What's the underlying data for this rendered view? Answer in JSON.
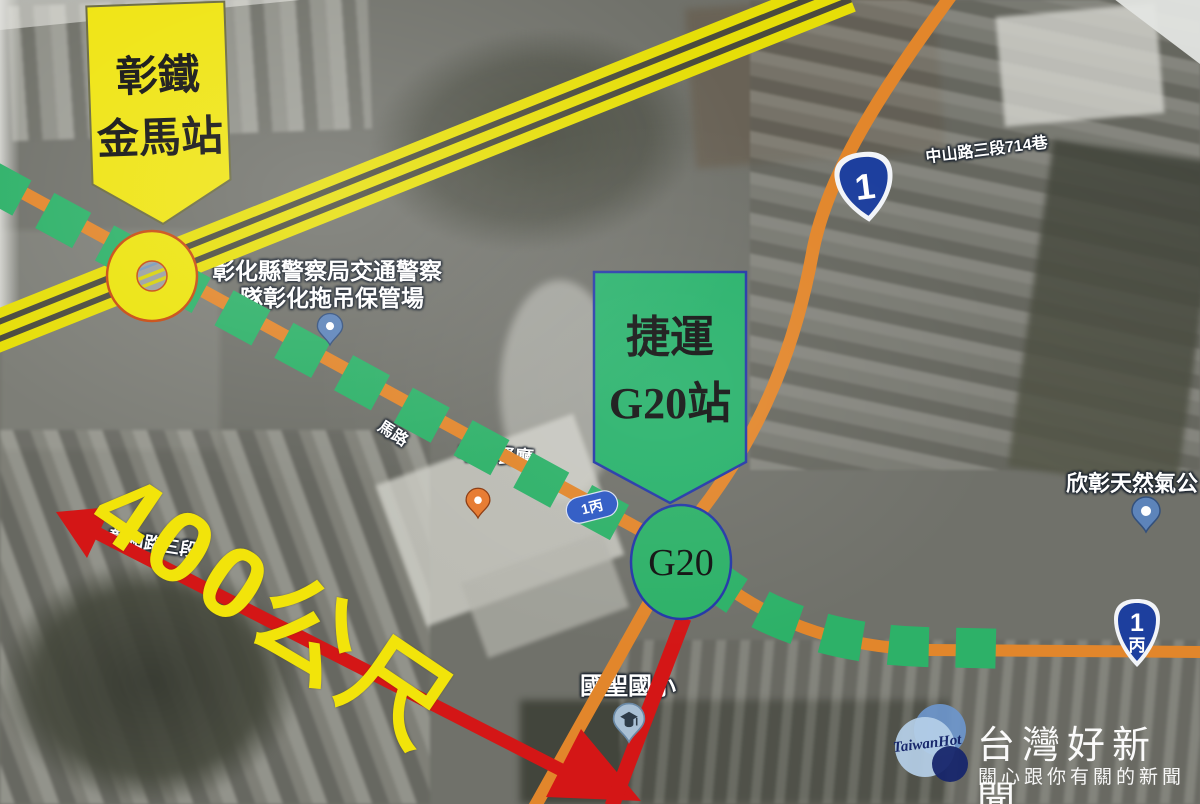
{
  "map": {
    "banners": {
      "rail_station": {
        "line1": "彰鐵",
        "line2": "金馬站"
      },
      "mrt_station": {
        "line1": "捷運",
        "line2": "G20站"
      }
    },
    "station_circle": {
      "label": "G20"
    },
    "distance": {
      "label": "400公尺"
    },
    "place_labels": {
      "police_line1": "彰化縣警察局交通警察",
      "police_line2": "隊彰化拖吊保管場",
      "lane": "中山路三段714巷",
      "gas_company": "欣彰天然氣公",
      "school": "國聖國小",
      "road_west": "彰和路三段",
      "road_fragment": "馬路",
      "restaurant": "丰典餐廳"
    },
    "route_markers": {
      "highway_1_shield": "1",
      "highway_1c_number": "1",
      "highway_1c_suffix": "丙",
      "highway_1c_oval": "1丙"
    },
    "legend_colors": {
      "mrt_route_green": "#2db168",
      "road_orange": "#e2862b",
      "railway_yellow": "#e6de08",
      "distance_arrow_red": "#d41616",
      "rail_banner_yellow": "#efe410",
      "mrt_banner_green": "#28b26b",
      "shield_blue": "#1d3f9e"
    }
  },
  "watermark": {
    "logo_script": "TaiwanHot",
    "site_name": "台灣好新聞",
    "tagline": "關心跟你有關的新聞"
  }
}
